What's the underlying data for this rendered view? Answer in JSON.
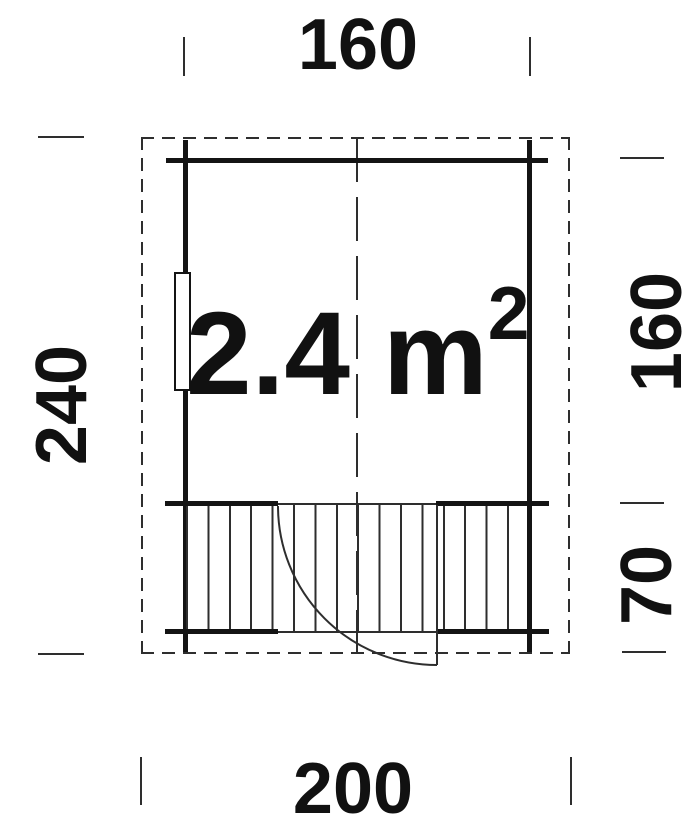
{
  "plan": {
    "area": {
      "base": "2.4 m",
      "exponent": "2",
      "display": "2.4 m²"
    },
    "dimensions": {
      "top_width": "160",
      "bottom_width": "200",
      "left_total_depth": "240",
      "right_upper_depth": "160",
      "right_lower_depth": "70"
    },
    "colors": {
      "bg": "#ffffff",
      "line": "#2e2e2e",
      "wall": "#141414",
      "text": "#111111"
    }
  }
}
